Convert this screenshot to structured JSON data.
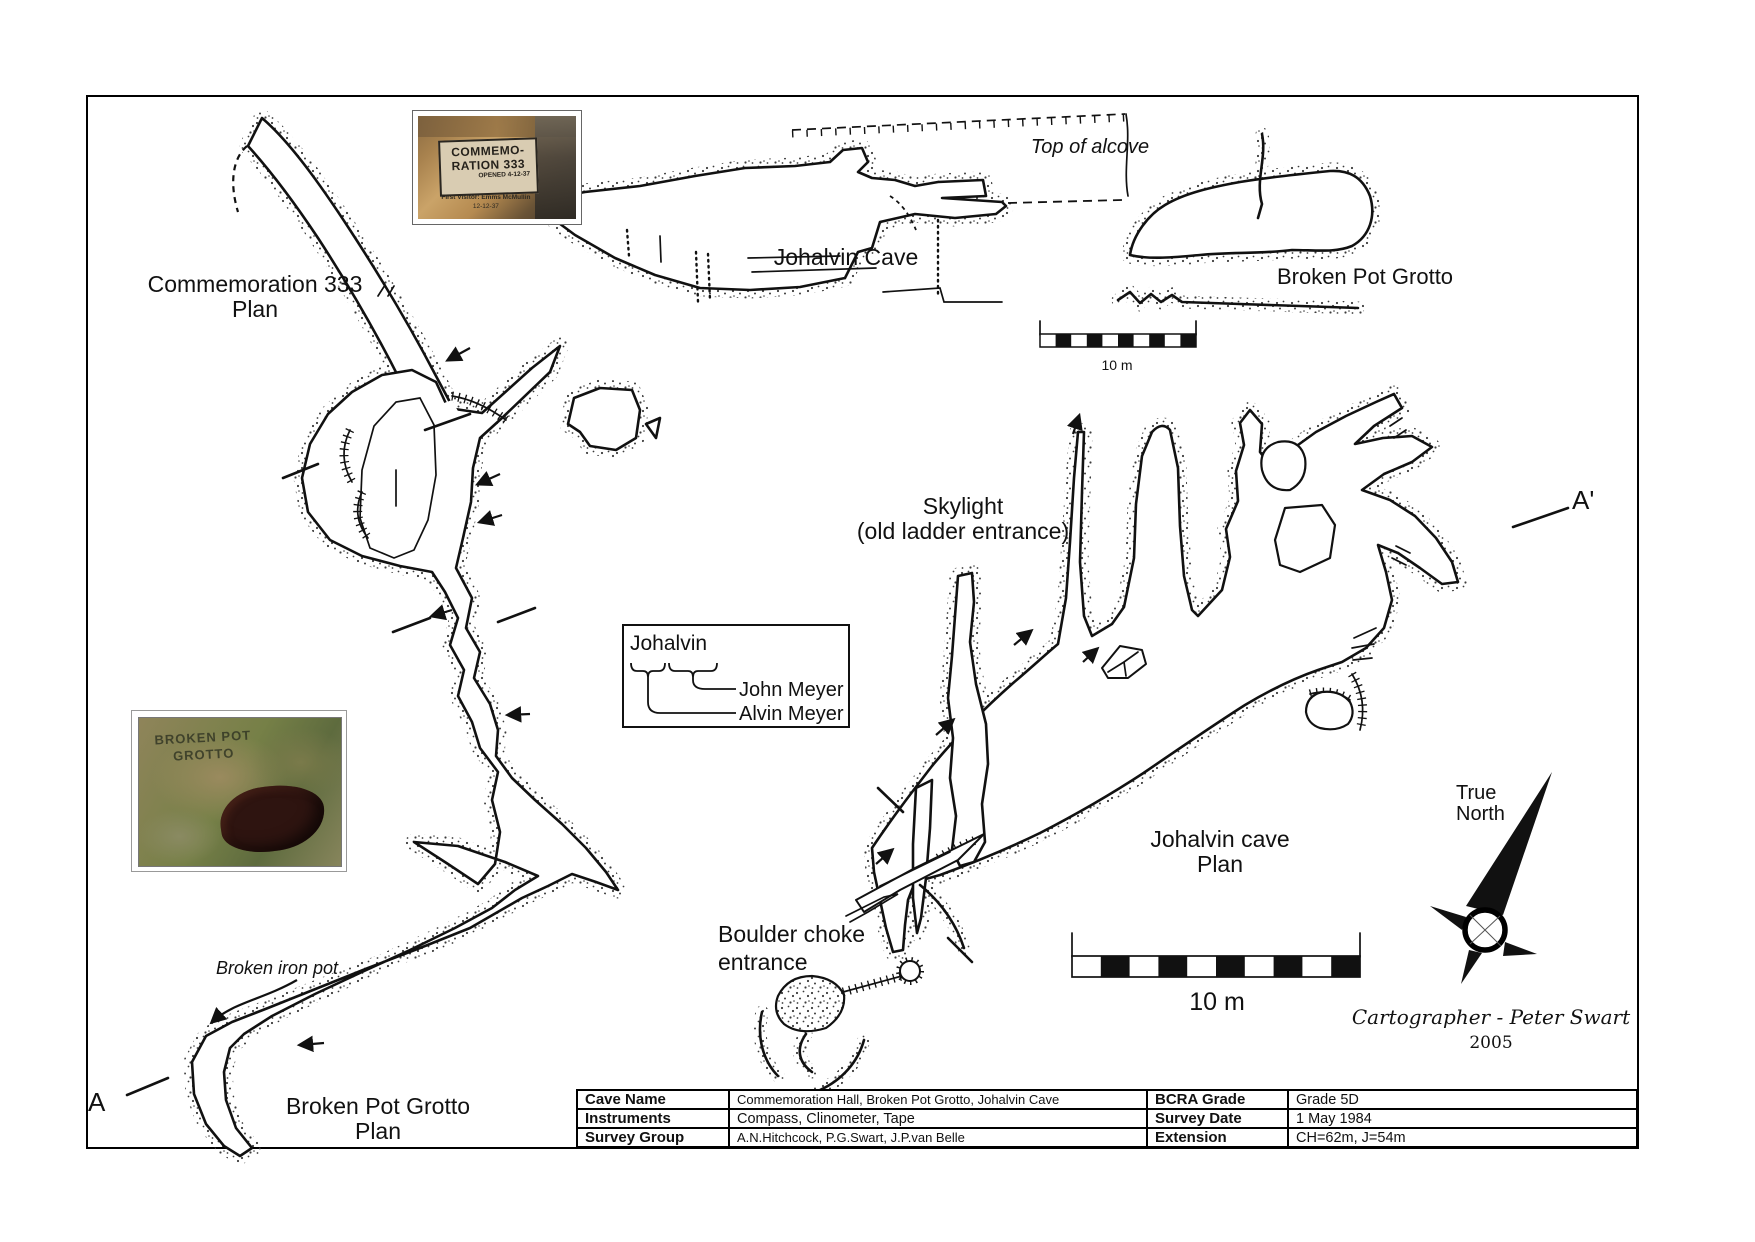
{
  "colors": {
    "ink": "#111111",
    "paper": "#ffffff",
    "stipple": "#3c3c3c"
  },
  "plans": {
    "commemoration": {
      "title": "Commemoration 333",
      "subtitle": "Plan"
    },
    "johalvin_section": {
      "title": "Johalvin Cave"
    },
    "broken_pot_section": {
      "title": "Broken Pot Grotto"
    },
    "johalvin_plan": {
      "title": "Johalvin cave",
      "subtitle": "Plan"
    },
    "broken_pot_plan": {
      "title": "Broken Pot Grotto",
      "subtitle": "Plan"
    }
  },
  "annotations": {
    "top_of_alcove": "Top of alcove",
    "skylight": "Skylight",
    "skylight_sub": "(old ladder entrance)",
    "boulder_choke": "Boulder choke",
    "boulder_choke_sub": "entrance",
    "broken_iron_pot": "Broken iron pot",
    "section_marker_a": "A",
    "section_marker_a_prime": "A'"
  },
  "derivation": {
    "compound": "Johalvin",
    "name_top": "John Meyer",
    "name_bottom": "Alvin Meyer"
  },
  "scale": {
    "top_label": "10 m",
    "bottom_label": "10 m"
  },
  "compass": {
    "label_line1": "True",
    "label_line2": "North"
  },
  "credits": {
    "cartographer": "Cartographer - Peter Swart",
    "year": "2005"
  },
  "photos": {
    "commemoration_sign": {
      "line1": "COMMEMO-",
      "line2": "RATION 333",
      "line3": "OPENED 4-12-37",
      "line4": "First Visitor: Emms McMullin",
      "line5": "12-12-37"
    },
    "grotto_sign": {
      "line1": "BROKEN POT",
      "line2": "GROTTO"
    }
  },
  "info_table": {
    "rows": [
      {
        "label_left": "Cave Name",
        "value_left": "Commemoration Hall, Broken Pot Grotto, Johalvin Cave",
        "label_right": "BCRA Grade",
        "value_right": "Grade 5D"
      },
      {
        "label_left": "Instruments",
        "value_left": "Compass, Clinometer, Tape",
        "label_right": "Survey Date",
        "value_right": "1 May 1984"
      },
      {
        "label_left": "Survey Group",
        "value_left": "A.N.Hitchcock, P.G.Swart, J.P.van Belle",
        "label_right": "Extension",
        "value_right": "CH=62m, J=54m"
      }
    ]
  }
}
